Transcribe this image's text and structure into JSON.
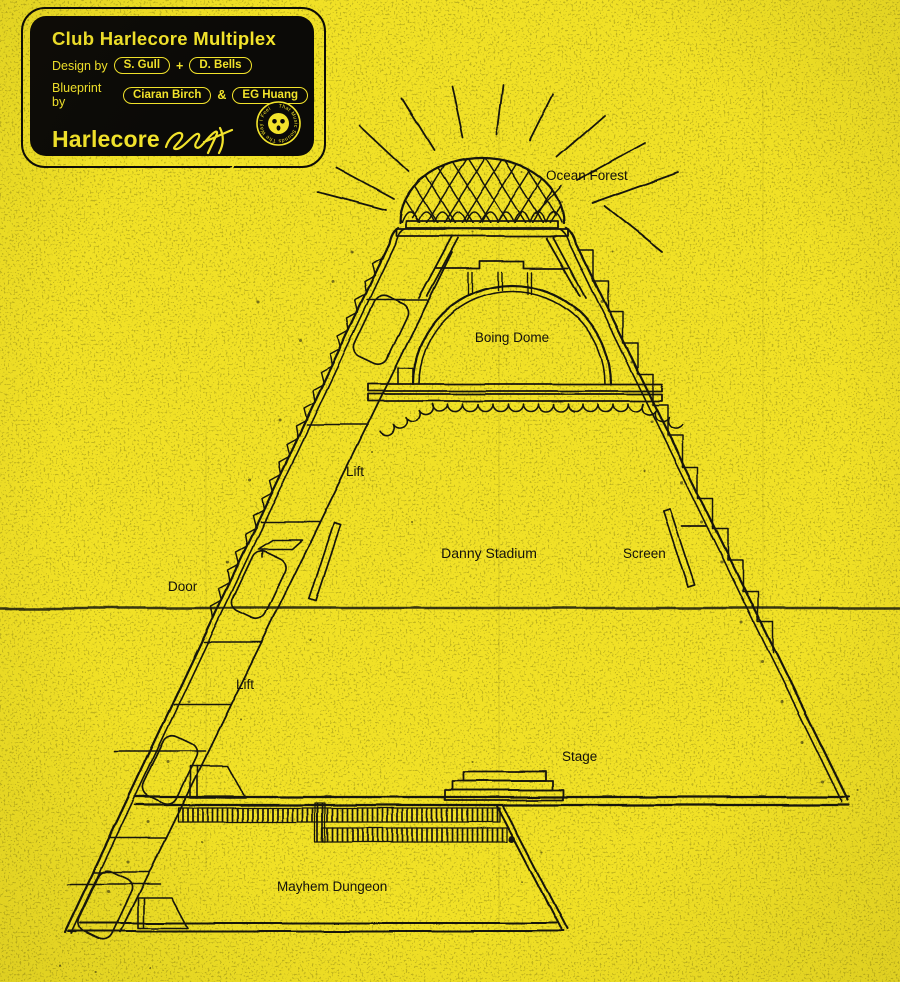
{
  "poster": {
    "background_color": "#F1E126",
    "ink_color": "#17150E",
    "accent_color": "#F2E32B"
  },
  "card": {
    "title": "Club Harlecore Multiplex",
    "design_prefix": "Design by",
    "design_name_1": "S. Gull",
    "design_joiner": "+",
    "design_name_2": "D. Bells",
    "blueprint_prefix": "Blueprint by",
    "blueprint_name_1": "Ciaran Birch",
    "blueprint_joiner": "&",
    "blueprint_name_2": "EG Huang",
    "logo_text": "Harlecore",
    "logo_scribble": "2021",
    "tagline": "That Music Sounds The Way I Feel",
    "badge_text": "That Music Sounds The Way I Feel"
  },
  "diagram": {
    "labels": {
      "ocean_forest": "Ocean Forest",
      "boing_dome": "Boing Dome",
      "lift_upper": "Lift",
      "danny_stadium": "Danny Stadium",
      "screen": "Screen",
      "door": "Door",
      "lift_lower": "Lift",
      "stage": "Stage",
      "mayhem_dungeon": "Mayhem Dungeon"
    }
  }
}
